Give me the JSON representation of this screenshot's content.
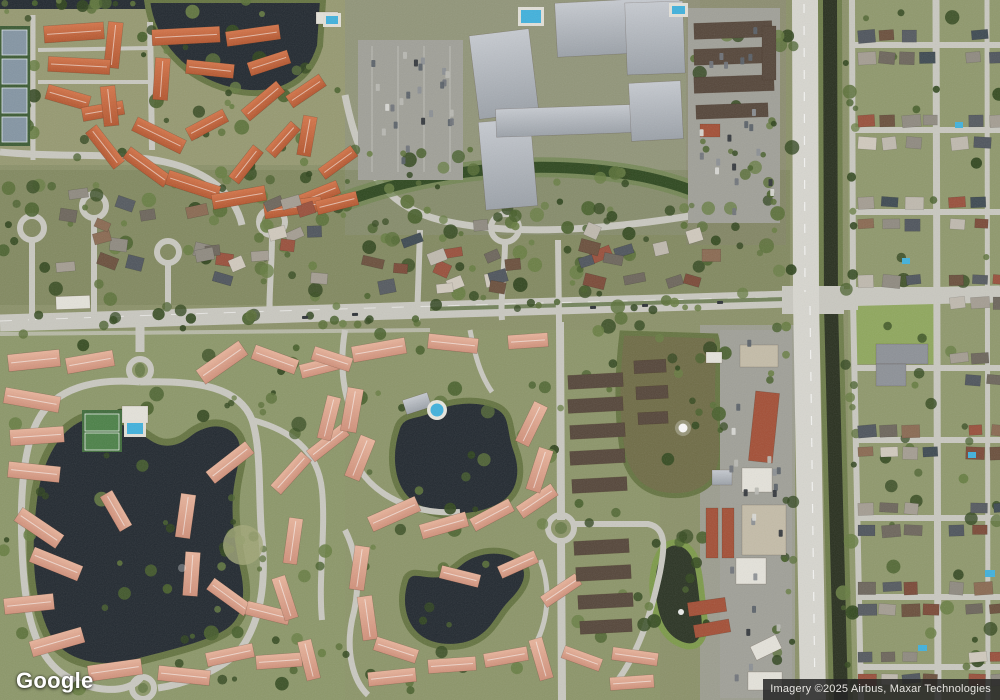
{
  "branding": {
    "logo_text": "Google"
  },
  "attribution": {
    "text": "Imagery ©2025 Airbus, Maxar Technologies"
  },
  "map": {
    "view_type": "satellite"
  },
  "colors": {
    "veg_base": "#8b9169",
    "veg_light": "#a3a878",
    "veg_pale": "#b2b189",
    "veg_dark_band": "#6f7a4e",
    "field_green": "#8fa75d",
    "water_dark": "#222930",
    "pond_olive": "#6f6c46",
    "pond_dark": "#2b3424",
    "canal": "#29301f",
    "shore": "#657441",
    "road": "#c9c8c0",
    "road_bright": "#d7d6cf",
    "parking": "#a0a098",
    "roof_orange": "#b4562f",
    "roof_orange_lt": "#d4754a",
    "roof_salmon": "#d0907a",
    "roof_salmon_lt": "#e8b49c",
    "roof_gray": "#9ba1a8",
    "roof_gray_lt": "#c6cad0",
    "roof_brown": "#55463a",
    "roof_white": "#e4e2da",
    "roof_tan": "#c4bca8",
    "roof_red": "#a34f36",
    "school_gray": "#8d9197",
    "pool": "#41b1dc",
    "court_blue": "#8495a3",
    "court_green": "#4c8148",
    "median_green": "#5d7040"
  },
  "palettes": {
    "trees": [
      "#33491f",
      "#48602c",
      "#5a7038",
      "#2f441d",
      "#677d42"
    ],
    "houses": [
      "#8f8a80",
      "#6d665c",
      "#a49d92",
      "#7b4a38",
      "#555a60",
      "#bfb9ae",
      "#6b503d",
      "#8a6a52",
      "#4f555d",
      "#99503c",
      "#3e4a52",
      "#d0c9bd"
    ],
    "cars": [
      "#30353a",
      "#d9d9d5",
      "#8b8f93",
      "#5a6168",
      "#b9b9b3",
      "#70747a"
    ]
  }
}
